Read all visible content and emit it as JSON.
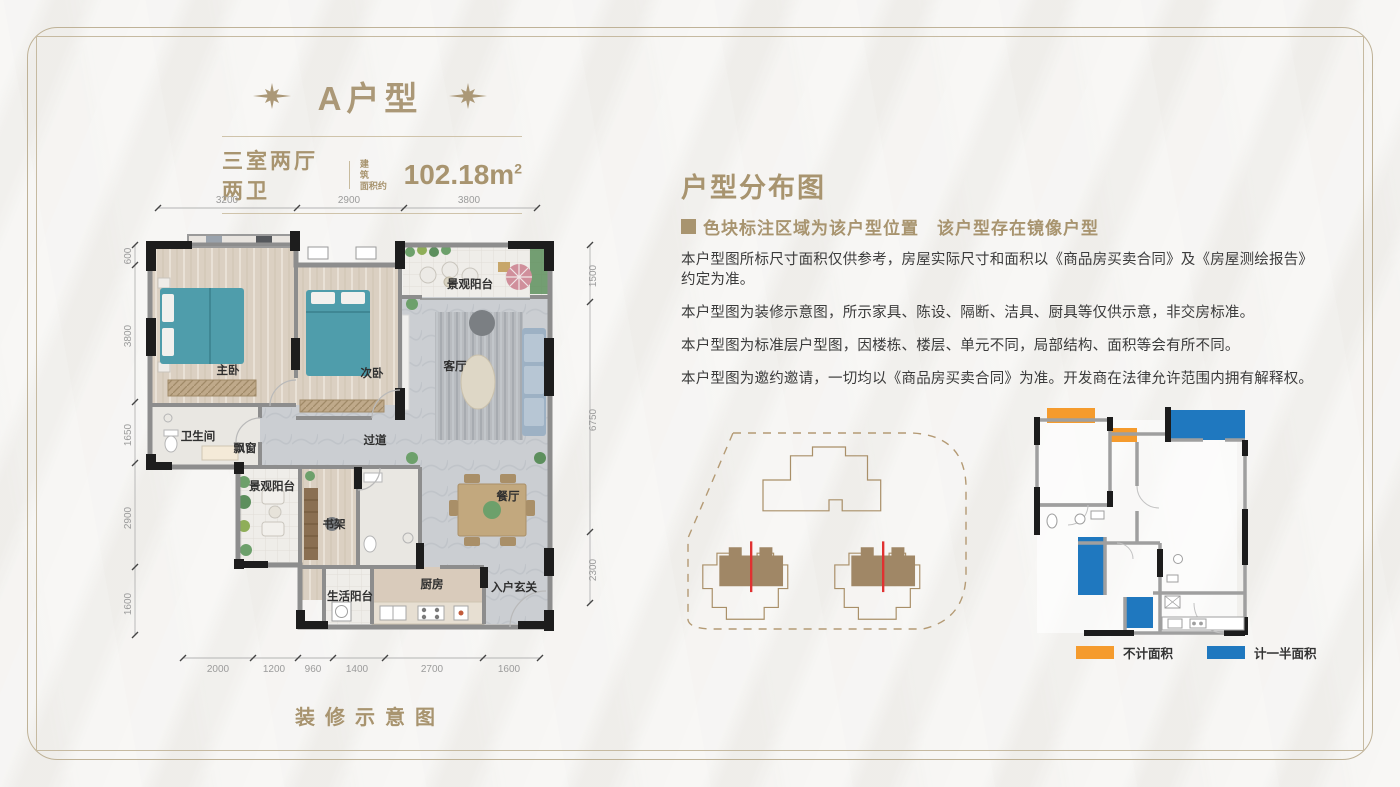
{
  "header": {
    "title": "A户型",
    "subtitle_rooms": "三室两厅两卫",
    "area_label_line1": "建 筑",
    "area_label_line2": "面积约",
    "area_value": "102.18m",
    "area_sup": "2"
  },
  "floorplan": {
    "caption": "装修示意图",
    "labels": {
      "bay_window": "飘窗",
      "master": "主卧",
      "second": "次卧",
      "living": "客厅",
      "balcony_top": "景观阳台",
      "bath": "卫生间",
      "hall": "过道",
      "balcony_left": "景观阳台",
      "bookshelf": "书架",
      "dining": "餐厅",
      "life_balcony": "生活阳台",
      "kitchen": "厨房",
      "entry": "入户玄关"
    },
    "dims_top": [
      "3200",
      "2900",
      "3800"
    ],
    "dims_left": [
      "600",
      "3800",
      "1650",
      "2900",
      "1600"
    ],
    "dims_right": [
      "1500",
      "6750",
      "2300"
    ],
    "dims_bottom": [
      "2000",
      "1200",
      "960",
      "1400",
      "2700",
      "1600"
    ]
  },
  "distribution": {
    "heading": "户型分布图",
    "note": "色块标注区域为该户型位置　该户型存在镜像户型",
    "disclaimers": [
      "本户型图所标尺寸面积仅供参考，房屋实际尺寸和面积以《商品房买卖合同》及《房屋测绘报告》约定为准。",
      "本户型图为装修示意图，所示家具、陈设、隔断、洁具、厨具等仅供示意，非交房标准。",
      "本户型图为标准层户型图，因楼栋、楼层、单元不同，局部结构、面积等会有所不同。",
      "本户型图为邀约邀请，一切均以《商品房买卖合同》为准。开发商在法律允许范围内拥有解释权。"
    ],
    "legend": [
      {
        "label": "不计面积",
        "color": "#F59B2D"
      },
      {
        "label": "计一半面积",
        "color": "#1F78BF"
      }
    ],
    "colors": {
      "accent_gold": "#a8946f",
      "unit_highlight": "#a08766",
      "mirror_line": "#e03131",
      "orange_area": "#F59B2D",
      "blue_area": "#1F78BF"
    }
  }
}
